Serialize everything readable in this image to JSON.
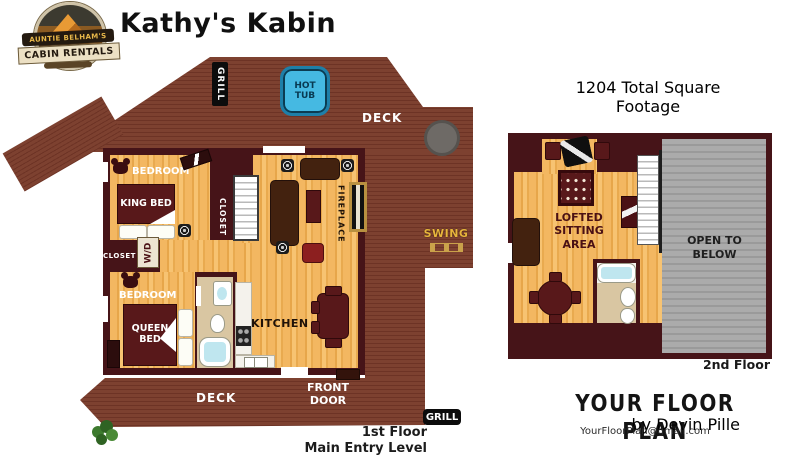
{
  "header": {
    "title": "Kathy's Kabin",
    "logo": {
      "top_text": "AUNTIE BELHAM'S",
      "bottom_text": "CABIN RENTALS"
    }
  },
  "floor1": {
    "labels": {
      "grill_top": "GRILL",
      "hot_tub": "HOT TUB",
      "deck_top": "DECK",
      "swing": "SWING",
      "bedroom1": "BEDROOM",
      "king_bed": "KING BED",
      "closet1": "CLOSET",
      "closet2": "CLOSET",
      "washer_dryer": "W/D",
      "fireplace": "FIREPLACE",
      "bedroom2": "BEDROOM",
      "queen_bed": "QUEEN BED",
      "kitchen": "KITCHEN",
      "front_door": "FRONT DOOR",
      "deck_bottom": "DECK",
      "grill_bottom": "GRILL"
    },
    "caption": {
      "line1": "1st Floor",
      "line2": "Main Entry Level"
    }
  },
  "floor2": {
    "heading": "1204 Total Square Footage",
    "labels": {
      "lofted": "LOFTED SITTING AREA",
      "open_below": "OPEN TO BELOW"
    },
    "caption": "2nd Floor"
  },
  "branding": {
    "name": "YOUR FLOOR PLAN",
    "byline": "by Devin Pille",
    "email": "YourFloorPlan@gmail.com"
  },
  "colors": {
    "deck_brown": "#7d4130",
    "wall_maroon": "#461418",
    "wood_floor": "#f3b761",
    "hot_tub_blue": "#45b9e2",
    "open_below_gray": "#a3a3a3",
    "swing_gold": "#e8b53c",
    "bathroom_tan": "#d9c6a2"
  }
}
